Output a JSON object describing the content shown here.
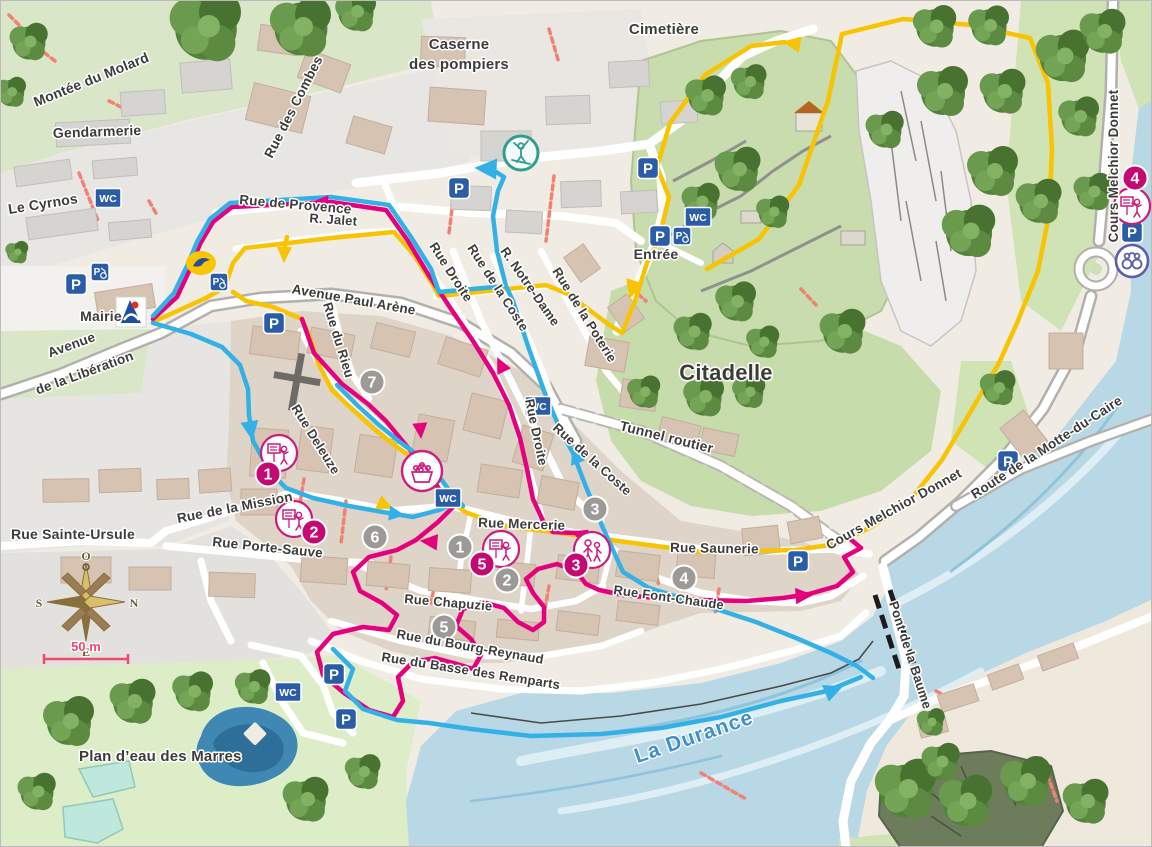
{
  "labels": {
    "montee_du_molard": "Montée du Molard",
    "gendarmerie": "Gendarmerie",
    "le_cyrnos": "Le Cyrnos",
    "rue_des_combes": "Rue des Combes",
    "caserne_1": "Caserne",
    "caserne_2": "des pompiers",
    "cimetiere": "Cimetière",
    "rue_de_provence": "Rue de Provence",
    "r_jalet": "R. Jalet",
    "avenue_paul_arene": "Avenue Paul Arène",
    "entree": "Entrée",
    "citadelle": "Citadelle",
    "cours_melchior_donnet": "Cours Melchior Donnet",
    "route_motte_caire": "Route de la Motte-du-Caire",
    "mairie": "Mairie",
    "avenue_lib_1": "Avenue",
    "avenue_lib_2": "de la Libération",
    "rue_du_rieu": "Rue du Rieu",
    "rue_deleuze": "Rue Deleuze",
    "rue_droite": "Rue Droite",
    "rue_de_la_coste": "Rue de la Coste",
    "r_notre_dame": "R. Notre-Dame",
    "rue_de_la_poterie": "Rue de la Poterie",
    "tunnel_routier": "Tunnel routier",
    "rue_de_la_mission": "Rue de la Mission",
    "rue_sainte_ursule": "Rue Sainte-Ursule",
    "rue_porte_sauve": "Rue Porte-Sauve",
    "rue_mercerie": "Rue Mercerie",
    "rue_saunerie": "Rue Saunerie",
    "rue_font_chaude": "Rue Font-Chaude",
    "rue_chapuzie": "Rue Chapuzie",
    "rue_bourg_reynaud": "Rue du Bourg-Reynaud",
    "rue_basse_remparts": "Rue du Basse des Remparts",
    "la_durance": "La Durance",
    "plan_deau": "Plan d’eau des Marres",
    "pont_de_la_baume": "Pont de la Baume"
  },
  "markers": {
    "pink": [
      "1",
      "2",
      "3",
      "4",
      "5"
    ],
    "gray": [
      "1",
      "2",
      "3",
      "4",
      "5",
      "6",
      "7"
    ]
  },
  "icons": {
    "parking": "P",
    "wc": "WC"
  },
  "compass": {
    "top": "O",
    "right": "N",
    "left": "S",
    "bottom": "E"
  },
  "scale_label": "50 m",
  "colors": {
    "route_yellow": "#f8c300",
    "route_pink": "#e5007d",
    "route_blue": "#33b1e6",
    "river": "#b9d8e5",
    "parking_blue": "#2b5ca6",
    "marker_pink": "#c40a72",
    "marker_gray": "#9b9a97",
    "poi_teal": "#2f9e8f",
    "poi_purple": "#5d5db0"
  }
}
